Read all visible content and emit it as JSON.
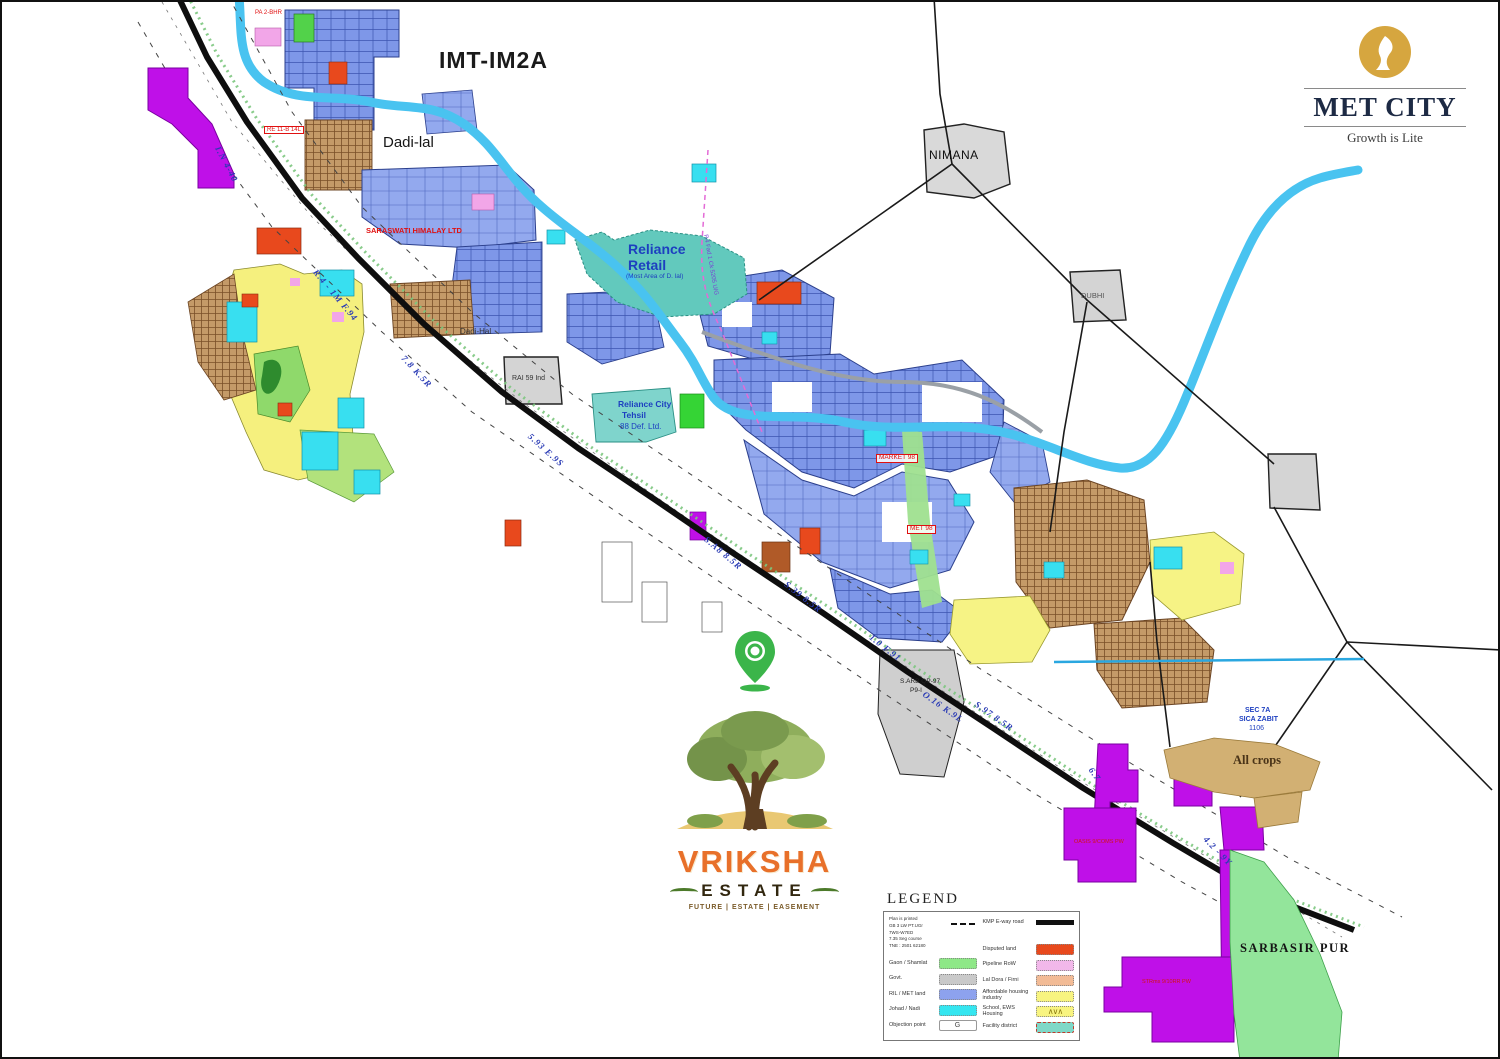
{
  "window_title": "IMT-IM2A master plan map",
  "brand": {
    "name": "MET CITY",
    "tagline": "Growth is Lite",
    "logo_icon": "reliance-flame-icon",
    "gold": "#d6a63f",
    "text_color": "#1d2a44"
  },
  "estate_logo": {
    "line1": "VRIKSHA",
    "line2": "ESTATE",
    "tagline": "FUTURE | ESTATE | EASEMENT",
    "pin_icon": "location-pin-icon",
    "tree_icon": "tree-illustration",
    "line1_color": "#e8702a",
    "line2_color": "#32270f"
  },
  "legend": {
    "title": "LEGEND",
    "info_lines": [
      "Plan is printed",
      "GB 3 LW PT.UGr",
      "7WS-W7ED",
      "7.35 Seg course",
      "TNE : 2501 62180"
    ],
    "left": [
      {
        "label": "Gaon / Shamlat",
        "swatch": "#8ee887"
      },
      {
        "label": "Govt.",
        "swatch": "#c9c9c9"
      },
      {
        "label": "RIL / MET land",
        "swatch": "#8da2ee"
      },
      {
        "label": "Johad / Nadi",
        "swatch": "#35e6f0"
      },
      {
        "label": "Objection point",
        "swatch": "g-letter"
      }
    ],
    "right": [
      {
        "label": "KMP E-way road",
        "swatch": "black-bar"
      },
      {
        "label": "Disputed land",
        "swatch": "#e8491d"
      },
      {
        "label": "Pipeline RoW",
        "swatch": "#f2b8ea"
      },
      {
        "label": "Lal Dora / Firni",
        "swatch": "#f2bb96"
      },
      {
        "label": "Affordable housing industry",
        "swatch": "#f8f480"
      },
      {
        "label": "School, EWS Housing",
        "swatch": "zigzag"
      },
      {
        "label": "Facility district",
        "swatch": "teal-dashed"
      }
    ]
  },
  "palette": {
    "road": "#0e0e0e",
    "river": "#49c3f0",
    "parcel_blue": "#7e97e8",
    "teal": "#62c9bd",
    "yellow": "#f6f385",
    "cyan": "#38dff0",
    "purple": "#bf10e8",
    "village_green": "#93e59b",
    "tan_crops": "#d2b073",
    "lal_dora": "#c49a68",
    "gray": "#d4d4d4",
    "red": "#e8491d",
    "pink": "#f2b8ea",
    "salmon": "#f2bb96",
    "road_label_blue": "#2a3bb5",
    "red_text": "#e01010",
    "brand_gold": "#d6a63f"
  },
  "map_labels": [
    {
      "name": "map-title",
      "text": "IMT-IM2A",
      "x": 437,
      "y": 47,
      "size": 23,
      "weight": "600",
      "ls": 1,
      "color": "#1a1a1a"
    },
    {
      "name": "village-label",
      "text": "Dadi-lal",
      "x": 381,
      "y": 133,
      "size": 15,
      "color": "#161616"
    },
    {
      "name": "village-label",
      "text": "Dadi-Hal",
      "x": 458,
      "y": 326,
      "size": 8,
      "color": "#333333"
    },
    {
      "name": "area-label",
      "text": "Reliance",
      "x": 626,
      "y": 240,
      "size": 14,
      "weight": "bold",
      "color": "#1d3fc0"
    },
    {
      "name": "area-label",
      "text": "Retail",
      "x": 626,
      "y": 256,
      "size": 14,
      "weight": "bold",
      "color": "#1d3fc0"
    },
    {
      "name": "area-sublabel",
      "text": "(Most Area of D. lal)",
      "x": 624,
      "y": 272,
      "size": 6.5,
      "color": "#1d3fc0"
    },
    {
      "name": "area-label",
      "text": "Reliance City",
      "x": 616,
      "y": 398,
      "size": 8.5,
      "weight": "bold",
      "color": "#1d3fc0"
    },
    {
      "name": "area-label",
      "text": "Tehsil",
      "x": 620,
      "y": 409,
      "size": 8.5,
      "weight": "bold",
      "color": "#1d3fc0"
    },
    {
      "name": "area-sublabel",
      "text": "88 Def. Ltd.",
      "x": 618,
      "y": 421,
      "size": 8,
      "color": "#1d3fc0"
    },
    {
      "name": "village-label",
      "text": "NIMANA",
      "x": 927,
      "y": 147,
      "size": 12,
      "ls": 0.5,
      "color": "#0f0f0f"
    },
    {
      "name": "village-label",
      "text": "DUBHI",
      "x": 1079,
      "y": 290,
      "size": 7.5,
      "color": "#555555"
    },
    {
      "name": "village-label",
      "text": "RAI 59 Ind",
      "x": 510,
      "y": 373,
      "size": 7,
      "color": "#333333"
    },
    {
      "name": "village-label",
      "text": "S.ARB QP-97",
      "x": 898,
      "y": 677,
      "size": 6.5,
      "color": "#222222"
    },
    {
      "name": "village-label",
      "text": "P9-I",
      "x": 908,
      "y": 686,
      "size": 6.5,
      "color": "#222222"
    },
    {
      "name": "village-label",
      "text": "SARBASIR PUR",
      "x": 1238,
      "y": 940,
      "size": 12.5,
      "serif": true,
      "weight": "bold",
      "ls": 1.5,
      "color": "#141414"
    },
    {
      "name": "area-label",
      "text": "All crops",
      "x": 1231,
      "y": 752,
      "size": 12.5,
      "serif": true,
      "weight": "bold",
      "color": "#4a3418"
    },
    {
      "name": "sector-label",
      "text": "SEC 7A",
      "x": 1243,
      "y": 705,
      "size": 7,
      "weight": "bold",
      "color": "#1d3fc0"
    },
    {
      "name": "sector-label",
      "text": "SICA ZABIT",
      "x": 1237,
      "y": 714,
      "size": 7,
      "weight": "bold",
      "color": "#1d3fc0"
    },
    {
      "name": "sector-label",
      "text": "1106",
      "x": 1247,
      "y": 723,
      "size": 7,
      "color": "#1d3fc0"
    },
    {
      "name": "owner-label",
      "text": "SARASWATI HIMALAY LTD",
      "x": 364,
      "y": 225,
      "size": 7.5,
      "weight": "bold",
      "color": "#e01010"
    },
    {
      "name": "plot-code",
      "text": "MARKET 98",
      "x": 874,
      "y": 452,
      "size": 6.5,
      "color": "#e01010",
      "boxed": true
    },
    {
      "name": "plot-code",
      "text": "MET 98",
      "x": 905,
      "y": 523,
      "size": 6.5,
      "color": "#e01010",
      "boxed": true
    },
    {
      "name": "plot-code",
      "text": "RE 11-B 14L",
      "x": 262,
      "y": 124,
      "size": 6,
      "color": "#e01010",
      "boxed": true
    },
    {
      "name": "plot-code",
      "text": "PA 2-BHR",
      "x": 253,
      "y": 8,
      "size": 6,
      "color": "#e01010"
    },
    {
      "name": "plot-code",
      "text": "OASIS 9/COMS PW",
      "x": 1072,
      "y": 838,
      "size": 5.5,
      "color": "#d01515"
    },
    {
      "name": "plot-code",
      "text": "STRms 9/10RR PW",
      "x": 1140,
      "y": 978,
      "size": 5.5,
      "color": "#d01515"
    },
    {
      "name": "road-label",
      "text": "I.N 4-40",
      "x": 219,
      "y": 143,
      "rot": 62,
      "size": 9,
      "road": true
    },
    {
      "name": "road-label",
      "text": "R.4 - 1M F.94",
      "x": 316,
      "y": 266,
      "rot": 50,
      "size": 9,
      "road": true
    },
    {
      "name": "road-label",
      "text": "7.8 K.5R",
      "x": 404,
      "y": 352,
      "rot": 47,
      "size": 9,
      "road": true
    },
    {
      "name": "road-label",
      "text": "5.93 E.9S",
      "x": 530,
      "y": 430,
      "rot": 42,
      "size": 9,
      "road": true
    },
    {
      "name": "road-label",
      "text": "S.A8 8.5R",
      "x": 706,
      "y": 533,
      "rot": 40,
      "size": 9,
      "road": true
    },
    {
      "name": "road-label",
      "text": "S.39 8.5R",
      "x": 786,
      "y": 578,
      "rot": 38,
      "size": 9,
      "road": true
    },
    {
      "name": "road-label",
      "text": "1.0 F.91",
      "x": 871,
      "y": 631,
      "rot": 38,
      "size": 9,
      "road": true
    },
    {
      "name": "road-label",
      "text": "O.16 K.9L",
      "x": 924,
      "y": 688,
      "rot": 35,
      "size": 9,
      "road": true
    },
    {
      "name": "road-label",
      "text": "S.97 8.5R",
      "x": 976,
      "y": 698,
      "rot": 35,
      "size": 9,
      "road": true
    },
    {
      "name": "road-label",
      "text": "6.7",
      "x": 1092,
      "y": 764,
      "rot": 55,
      "size": 9,
      "road": true
    },
    {
      "name": "road-label",
      "text": "4.2 - 9Y",
      "x": 1206,
      "y": 833,
      "rot": 46,
      "size": 9,
      "road": true
    },
    {
      "name": "pipeline-label",
      "text": "P.4 Fad 1 Ck 5205 U/G",
      "x": 706,
      "y": 232,
      "rot": 80,
      "size": 6,
      "color": "#7a3fd4"
    }
  ]
}
